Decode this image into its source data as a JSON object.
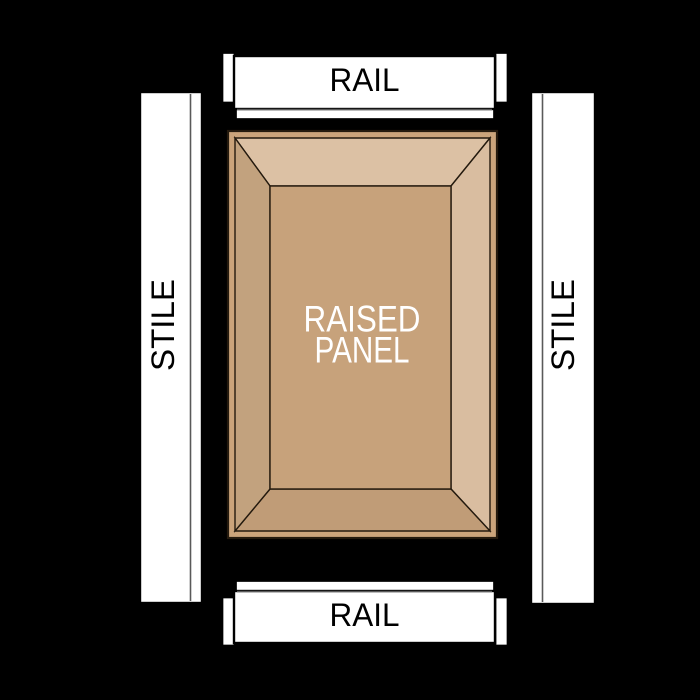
{
  "labels": {
    "rail_top": "RAIL",
    "rail_bottom": "RAIL",
    "stile_left": "STILE",
    "stile_right": "STILE",
    "panel_line1": "RAISED",
    "panel_line2": "PANEL"
  },
  "colors": {
    "background": "#000000",
    "frame_fill": "#ffffff",
    "frame_outline": "#000000",
    "profile_line": "#5a5a5a",
    "panel_outline": "#241a0e",
    "panel_edge": "#cba47b",
    "panel_field": "#c7a27b",
    "bevel_top": "#dcc1a4",
    "bevel_right": "#d9bda0",
    "bevel_bottom": "#c09c77",
    "bevel_left": "#c2a27e",
    "panel_label_color": "#ffffff",
    "frame_label_color": "#000000"
  }
}
